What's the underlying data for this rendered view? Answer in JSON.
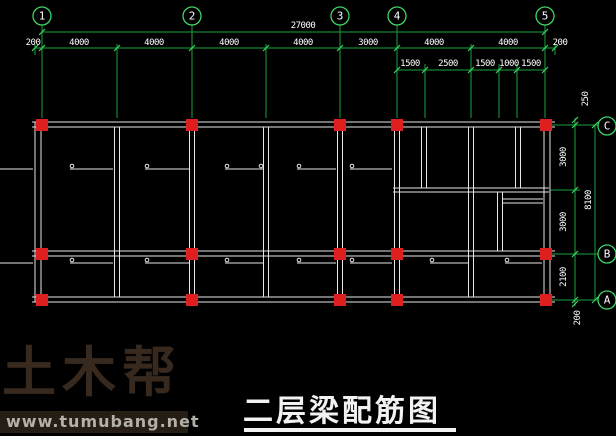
{
  "drawing": {
    "title": "二层梁配筋图",
    "axes_top": [
      "1",
      "2",
      "3",
      "4",
      "5"
    ],
    "axes_right": [
      "C",
      "B",
      "A"
    ],
    "dims": {
      "overall_width": "27000",
      "overall_height": "8100",
      "row1": [
        "200",
        "4000",
        "4000",
        "4000",
        "4000",
        "3000",
        "4000",
        "4000",
        "200"
      ],
      "row2": [
        "1500",
        "2500",
        "1500",
        "1000",
        "1500"
      ],
      "right": [
        "250",
        "3000",
        "3000",
        "2100",
        "200"
      ]
    }
  },
  "watermark": {
    "logo_text": "土木帮",
    "site_url": "www.tumubang.net"
  },
  "colors": {
    "background": "#000000",
    "dim_green": "#17a33c",
    "bright_green": "#3fd465",
    "beam_white": "#e6e6e6",
    "column_red": "#de1f1f",
    "dim_text_white": "#ffffff",
    "watermark_brown": "#38291e",
    "watermark_bar_bg": "#261d15",
    "watermark_bar_text": "#b3afa9",
    "title_color": "#f2f2f2"
  }
}
